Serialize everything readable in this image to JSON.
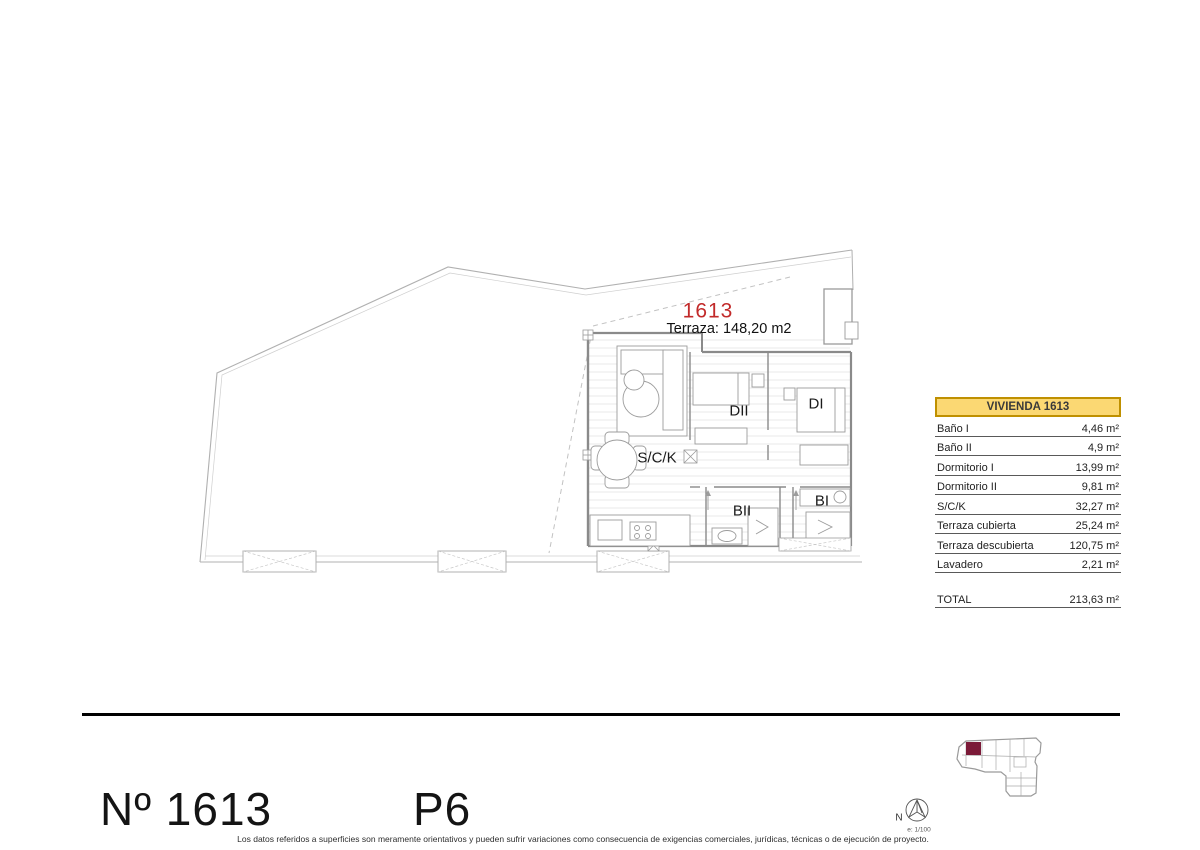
{
  "plan_labels": {
    "unit_number": "1613",
    "terrace": "Terraza: 148,20 m2",
    "room_dii": "DII",
    "room_di": "DI",
    "room_sck": "S/C/K",
    "room_bii": "BII",
    "room_bi": "BI"
  },
  "area_table": {
    "title": "VIVIENDA 1613",
    "rows": [
      {
        "label": "Baño I",
        "value": "4,46 m²"
      },
      {
        "label": "Baño II",
        "value": "4,9 m²"
      },
      {
        "label": "Dormitorio I",
        "value": "13,99 m²"
      },
      {
        "label": "Dormitorio II",
        "value": "9,81 m²"
      },
      {
        "label": "S/C/K",
        "value": "32,27 m²"
      },
      {
        "label": "Terraza cubierta",
        "value": "25,24 m²"
      },
      {
        "label": "Terraza descubierta",
        "value": "120,75 m²"
      },
      {
        "label": "Lavadero",
        "value": "2,21 m²"
      }
    ],
    "total": {
      "label": "TOTAL",
      "value": "213,63 m²"
    }
  },
  "title_block": {
    "unit_label": "Nº 1613",
    "floor_label": "P6",
    "north_label": "N",
    "scale_label": "e: 1/100",
    "disclaimer": "Los datos referidos a superficies son meramente orientativos y pueden sufrir variaciones como consecuencia de exigencias comerciales, jurídicas, técnicas o de ejecución de proyecto."
  },
  "colors": {
    "unit_number_red": "#C22A2A",
    "table_header_bg": "#FBD873",
    "table_header_border": "#BF9000",
    "keyplan_highlight": "#7B1A38"
  }
}
